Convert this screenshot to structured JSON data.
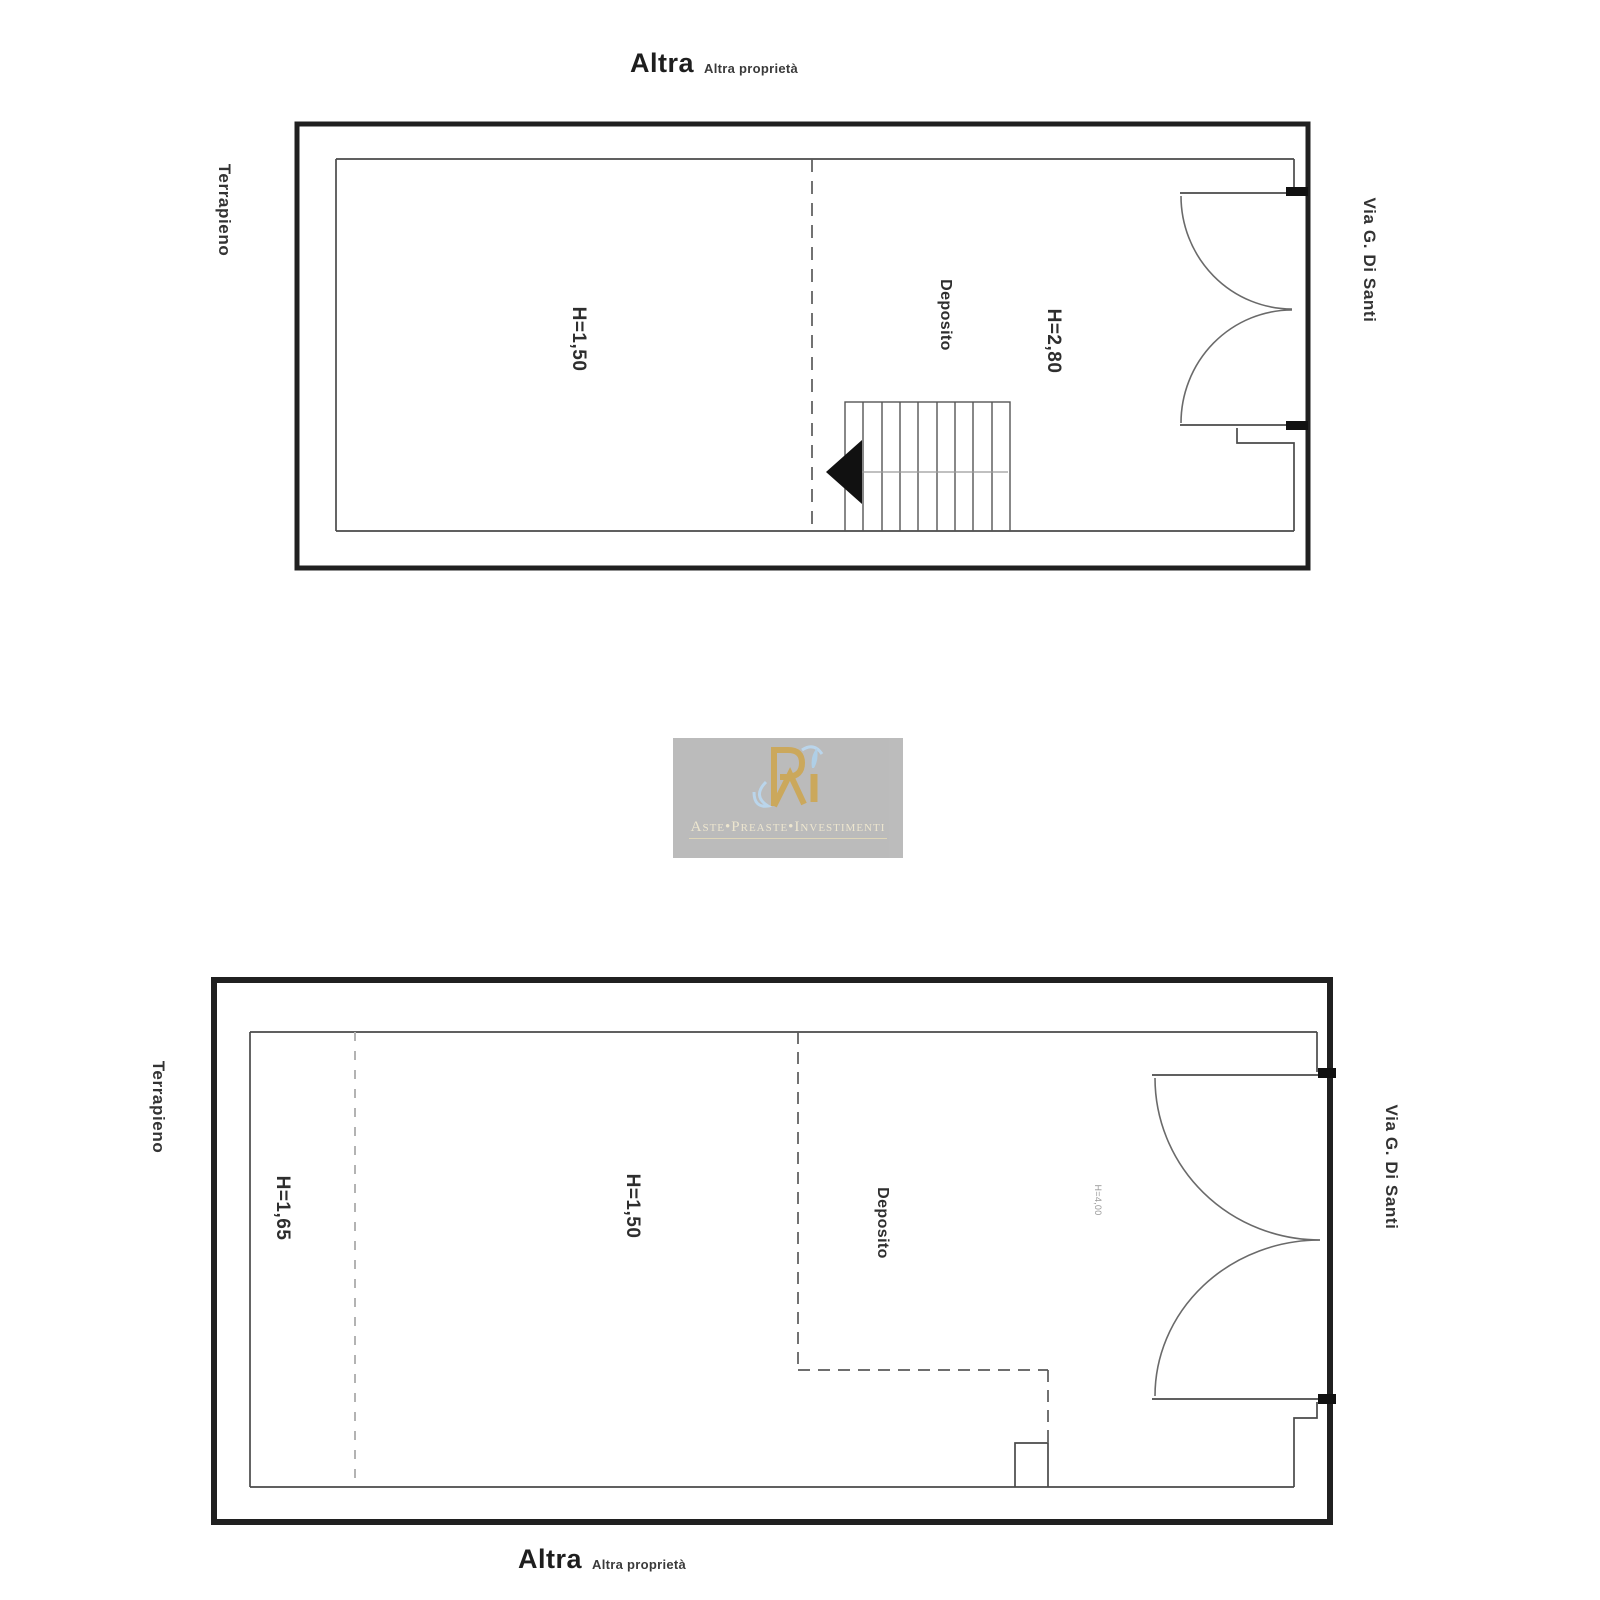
{
  "page": {
    "background": "#ffffff"
  },
  "watermark": {
    "brand_text": "Aste•Preaste•Investimenti",
    "box_color": "#b6b6b6",
    "gold": "#c7a14f",
    "blue": "#aecde8",
    "text_color": "#ece4cb"
  },
  "plan_upper": {
    "boundary_top_label": {
      "bold": "Altra",
      "small": "Altra proprietà"
    },
    "boundary_left_label": "Terrapieno",
    "boundary_right_label": "Via G. Di Santi",
    "rooms": {
      "main_height": "H=1,50",
      "deposito_label": "Deposito",
      "deposito_height": "H=2,80"
    }
  },
  "plan_lower": {
    "boundary_left_label": "Terrapieno",
    "boundary_right_label": "Via G. Di Santi",
    "boundary_bottom_label": {
      "bold": "Altra",
      "small": "Altra proprietà"
    },
    "rooms": {
      "left_zone_height": "H=1,65",
      "main_height": "H=1,50",
      "deposito_label": "Deposito",
      "door_note": "H=4,00"
    }
  },
  "line_colors": {
    "wall": "#202020",
    "thin_line": "#4a4a4a",
    "dashed_partition": "#5a5a5a",
    "light_dashed": "#b3b3b3",
    "door_arc": "#6a6a6a"
  }
}
